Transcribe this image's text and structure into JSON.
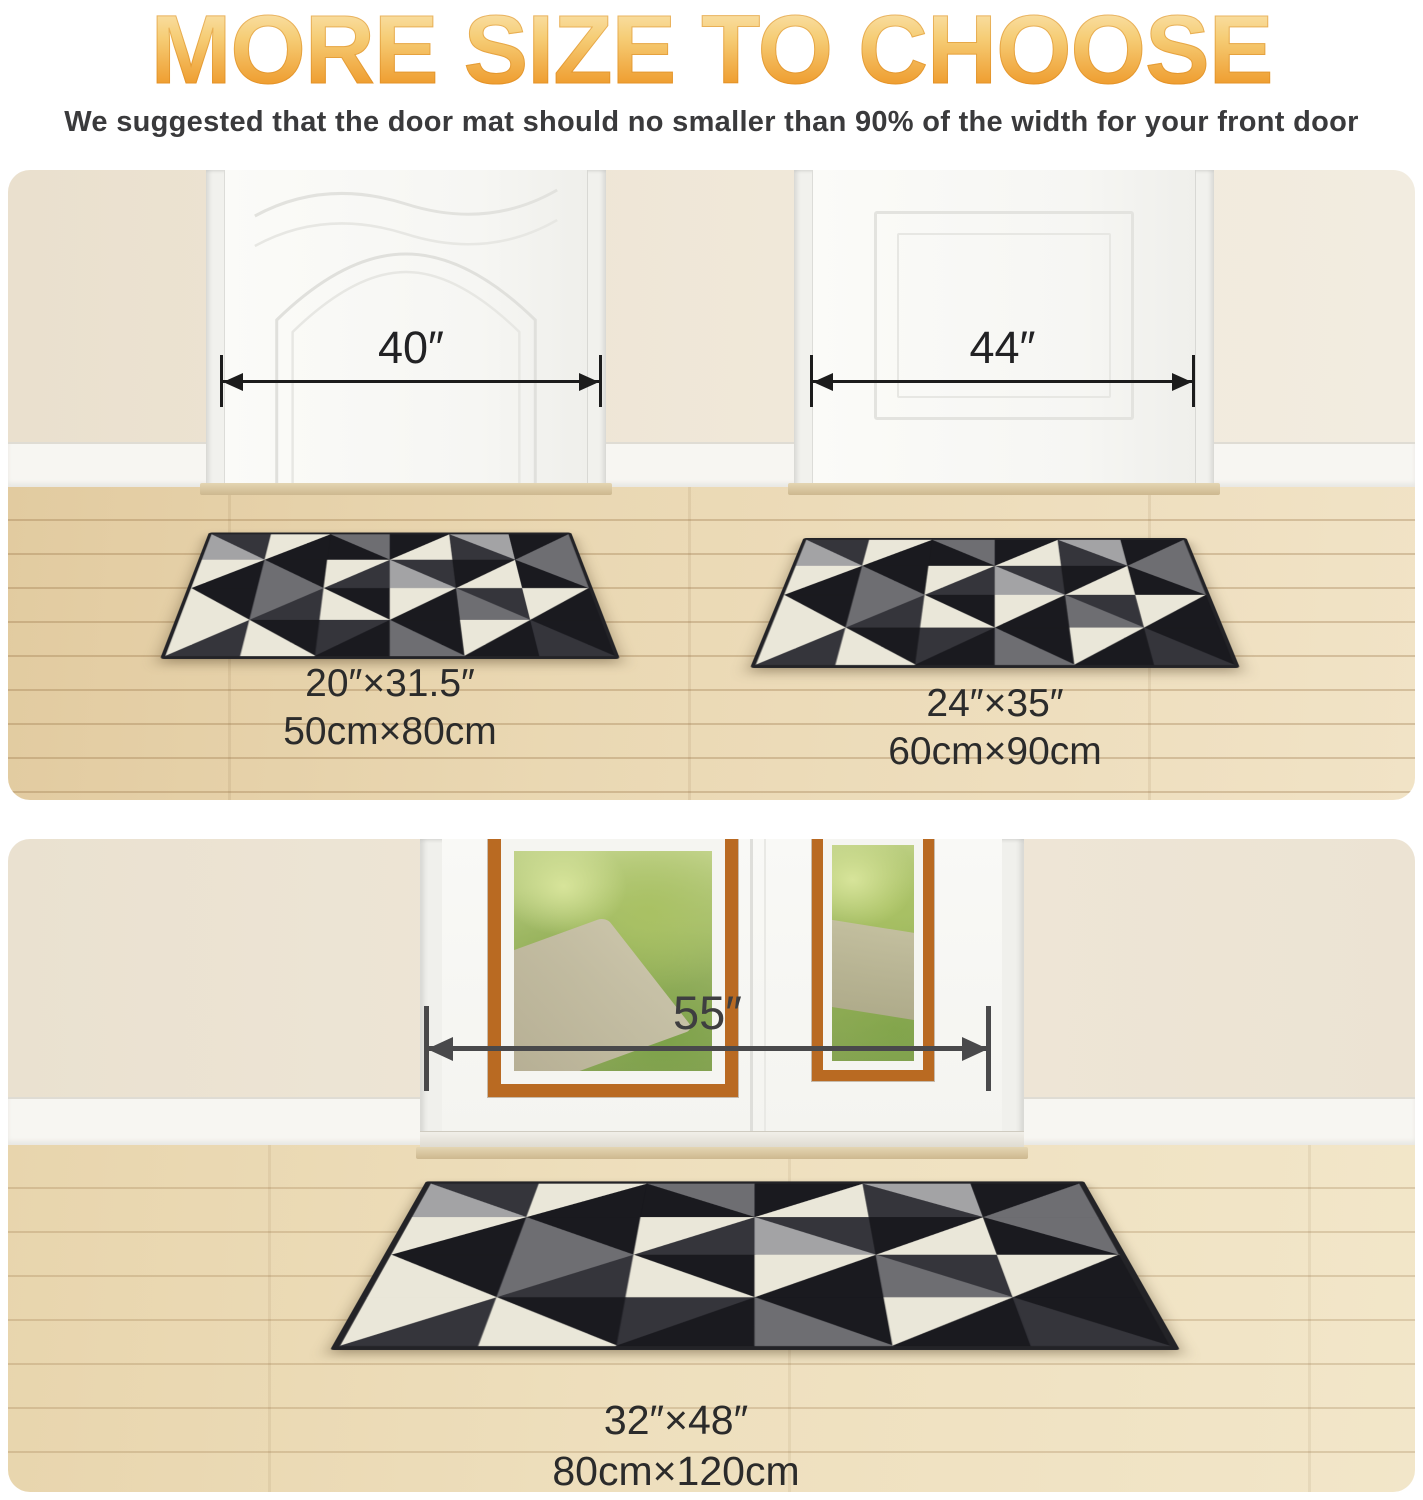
{
  "header": {
    "title": "MORE SIZE TO CHOOSE",
    "subtitle": "We suggested that the door mat should no smaller than 90% of the width for your front door"
  },
  "scenes": {
    "top_left": {
      "door_width": "40″",
      "mat_size_in": "20″×31.5″",
      "mat_size_cm": "50cm×80cm"
    },
    "top_right": {
      "door_width": "44″",
      "mat_size_in": "24″×35″",
      "mat_size_cm": "60cm×90cm"
    },
    "bottom": {
      "door_width": "55″",
      "mat_size_in": "32″×48″",
      "mat_size_cm": "80cm×120cm"
    }
  },
  "colors": {
    "title_gradient_top": "#FBEBC4",
    "title_gradient_bottom": "#ED9520",
    "subtitle_text": "#3A3A3C",
    "dimension_arrow_top": "#1C1C1C",
    "dimension_arrow_bottom": "#49494B",
    "window_frame_orange": "#B96A22",
    "wall_beige": "#EDE4D3",
    "floor_wood": "#EAD8B3",
    "door_white": "#F8F8F5"
  },
  "mat_pattern": {
    "palette": [
      "#1A1A1F",
      "#35353B",
      "#6E6E72",
      "#A3A3A5",
      "#EAE7D9"
    ],
    "edge_color": "#232327",
    "cols": 6,
    "rows": 4,
    "cells": [
      [
        1,
        3,
        "tr"
      ],
      [
        4,
        0,
        "tl"
      ],
      [
        2,
        0,
        "tr"
      ],
      [
        0,
        4,
        "tl"
      ],
      [
        3,
        1,
        "tr"
      ],
      [
        0,
        2,
        "tl"
      ],
      [
        4,
        0,
        "tl"
      ],
      [
        0,
        2,
        "tr"
      ],
      [
        4,
        1,
        "tl"
      ],
      [
        1,
        3,
        "tr"
      ],
      [
        0,
        4,
        "tl"
      ],
      [
        2,
        0,
        "tr"
      ],
      [
        0,
        4,
        "tr"
      ],
      [
        2,
        1,
        "tl"
      ],
      [
        0,
        4,
        "tr"
      ],
      [
        4,
        0,
        "tl"
      ],
      [
        1,
        2,
        "tr"
      ],
      [
        4,
        0,
        "tl"
      ],
      [
        4,
        1,
        "tl"
      ],
      [
        0,
        4,
        "tr"
      ],
      [
        1,
        0,
        "tl"
      ],
      [
        0,
        2,
        "tr"
      ],
      [
        4,
        0,
        "tl"
      ],
      [
        0,
        1,
        "tr"
      ]
    ]
  }
}
